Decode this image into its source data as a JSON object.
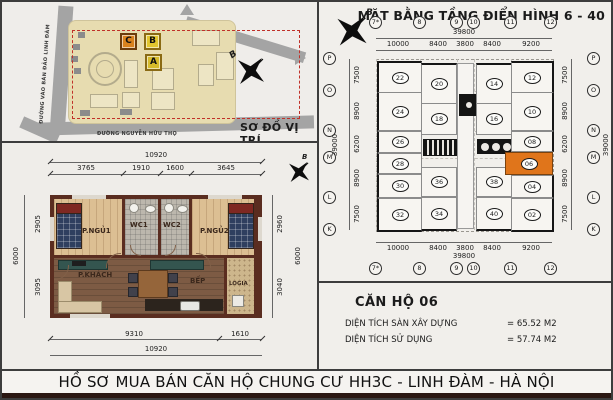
{
  "title_bar": "HỒ SƠ MUA BÁN CĂN HỘ CHUNG CƯ HH3C - LINH ĐÀM - HÀ NỘI",
  "site_map": {
    "caption": "SƠ ĐỒ VỊ TRÍ",
    "road_left": "ĐƯỜNG VÀO BÁN ĐẢO LINH ĐÀM",
    "road_bottom": "ĐƯỜNG NGUYỄN HỮU THỌ",
    "building_c": "C",
    "building_b": "B",
    "building_a": "A",
    "compass": "B",
    "colors": {
      "block_c": "#d9821e",
      "block_b": "#e2c62f",
      "block_a": "#d6bb2b",
      "site_fill": "#e7dcb0",
      "road": "#a4a4a4",
      "boundary_dash": "#c03028"
    }
  },
  "floor_plan": {
    "title": "MẶT BẰNG TẦNG ĐIỂN HÌNH 6 - 40",
    "compass": "B",
    "col_axes": [
      "7*",
      "8",
      "9",
      "10",
      "11",
      "12"
    ],
    "row_axes": [
      "P",
      "O",
      "N",
      "M",
      "L",
      "K"
    ],
    "dim_total_width": "39800",
    "dims_width": [
      "10000",
      "8400",
      "3800",
      "8400",
      "9200"
    ],
    "dim_total_height": "39000",
    "dims_height": [
      "7500",
      "8900",
      "6200",
      "8900",
      "7500"
    ],
    "units": [
      "22",
      "24",
      "26",
      "28",
      "30",
      "32",
      "20",
      "18",
      "36",
      "34",
      "14",
      "16",
      "38",
      "40",
      "12",
      "10",
      "08",
      "06",
      "04",
      "02"
    ],
    "highlight_unit": "06",
    "highlight_color": "#e0751b"
  },
  "apartment_plan": {
    "compass": "B",
    "dim_total_top": "10920",
    "dims_top": [
      "3765",
      "1910",
      "1600",
      "3645"
    ],
    "dims_bottom": [
      "9310",
      "1610"
    ],
    "dim_total_bottom": "10920",
    "dim_total_left": "6000",
    "dims_left": [
      "2905",
      "3095"
    ],
    "dim_total_right": "6000",
    "dims_right": [
      "2960",
      "3040"
    ],
    "rooms": {
      "bedroom1": "P.NGỦ1",
      "wc1": "WC1",
      "wc2": "WC2",
      "bedroom2": "P.NGỦ2",
      "living": "P.KHÁCH",
      "kitchen": "BẾP",
      "loggia": "LOGIA"
    }
  },
  "unit_info": {
    "title": "CĂN HỘ 06",
    "rows": [
      {
        "label": "DIỆN TÍCH SÀN XÂY DỰNG",
        "value": "= 65.52 M2"
      },
      {
        "label": "DIỆN TÍCH SỬ DỤNG",
        "value": "= 57.74 M2"
      }
    ]
  }
}
